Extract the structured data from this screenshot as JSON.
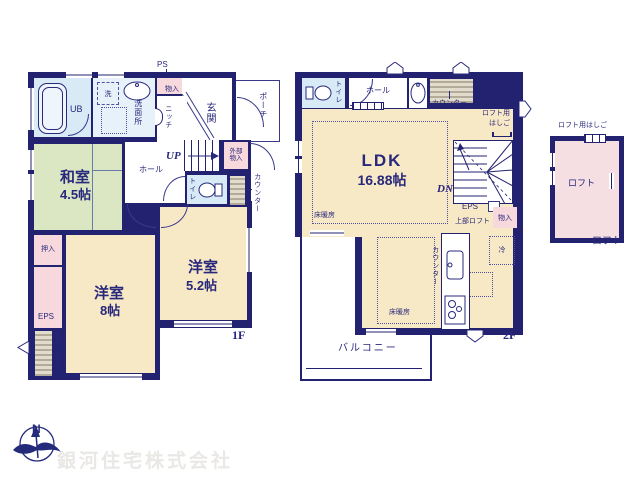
{
  "f1": {
    "floor_label": "1F",
    "ub": "UB",
    "washer": "洗",
    "washroom": "洗面所",
    "storage_top": "物入",
    "ps_top": "PS",
    "niche": "ニッチ",
    "entrance": "玄関",
    "porch": "ポーチ",
    "up": "UP",
    "ext_storage_1": "外部",
    "ext_storage_2": "物入",
    "hall": "ホール",
    "toilet": "トイレ",
    "counter_right": "カウンター",
    "ps_side": "PS",
    "jp_room": "和室",
    "jp_room_size": "4.5帖",
    "closet": "押入",
    "eps": "EPS",
    "counter_left": "カウンター",
    "west8": "洋室",
    "west8_size": "8帖",
    "west52": "洋室",
    "west52_size": "5.2帖"
  },
  "f2": {
    "floor_label": "2F",
    "toilet": "トイレ",
    "hall": "ホール",
    "counter_top": "カウンター",
    "loft_ladder_1": "ロフト用",
    "loft_ladder_2": "はしご",
    "ldk": "LDK",
    "ldk_size": "16.88帖",
    "dn": "DN",
    "eps": "EPS",
    "upper_loft": "上部ロフト",
    "storage": "物入",
    "fridge": "冷",
    "kitchen_counter": "カウンター",
    "floor_heat_1": "床暖房",
    "floor_heat_2": "床暖房",
    "balcony": "バルコニー"
  },
  "loft": {
    "ladder_label": "ロフト用はしご",
    "room": "ロフト",
    "floor_label": "ロフト"
  },
  "footer": {
    "company": "銀河住宅株式会社",
    "north": "N"
  },
  "colors": {
    "wall": "#232270",
    "room_cream": "#f8e9c6",
    "room_green": "#dbe7c2",
    "room_blue": "#d8eaf6",
    "room_pink": "#f7d8dc",
    "loft_pink": "#f5dfe3",
    "counter_hatch": "#b3aa9a",
    "company_text": "#e9e8e5",
    "logo": "#232b7a"
  }
}
